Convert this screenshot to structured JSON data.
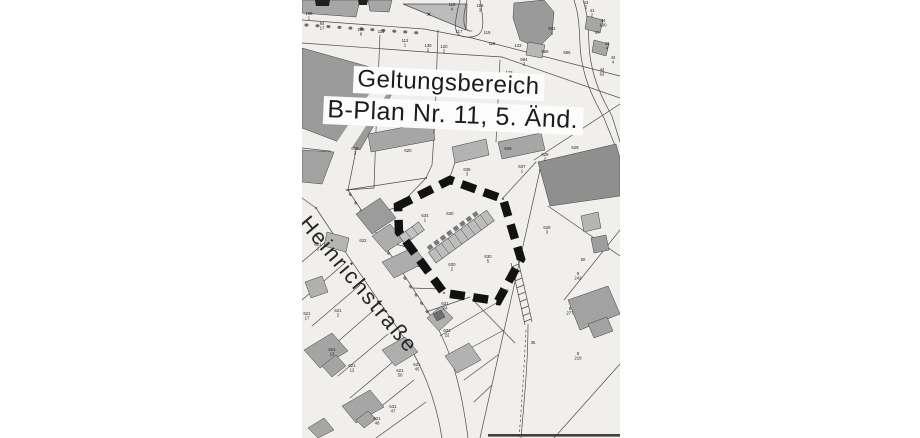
{
  "map": {
    "title_line1": "Geltungsbereich",
    "title_line2": "B-Plan Nr. 11, 5. Änd.",
    "street_name": "Heinrichstraße",
    "colors": {
      "paper": "#f1efec",
      "ink": "#4c4c4c",
      "building": "#a6a6a6",
      "boundary": "#121212",
      "label_ink": "#1f1f1f",
      "label_patch": "#fcfcfc",
      "title_ink": "#1c1c1c"
    },
    "parcel_labels": [
      {
        "x": 7,
        "y": 16,
        "t": "105/1"
      },
      {
        "x": 20,
        "y": 26,
        "t": "84/17"
      },
      {
        "x": 59,
        "y": 32,
        "t": "108/6"
      },
      {
        "x": 79,
        "y": 33,
        "t": "111"
      },
      {
        "x": 103,
        "y": 43,
        "t": "112/1"
      },
      {
        "x": 126,
        "y": 48,
        "t": "130/2"
      },
      {
        "x": 142,
        "y": 49,
        "t": "120/2"
      },
      {
        "x": 157,
        "y": 33,
        "t": "117"
      },
      {
        "x": 150,
        "y": 7,
        "t": "115/4"
      },
      {
        "x": 178,
        "y": 8,
        "t": "116/3"
      },
      {
        "x": 185,
        "y": 34,
        "t": "119"
      },
      {
        "x": 190,
        "y": 45,
        "t": "118"
      },
      {
        "x": 216,
        "y": 47,
        "t": "133"
      },
      {
        "x": 207,
        "y": 74,
        "t": "123"
      },
      {
        "x": 222,
        "y": 62,
        "t": "584/2"
      },
      {
        "x": 250,
        "y": 31,
        "t": "562/1"
      },
      {
        "x": 243,
        "y": 53,
        "t": "565"
      },
      {
        "x": 265,
        "y": 54,
        "t": "586"
      },
      {
        "x": 284,
        "y": 5,
        "t": "43/2"
      },
      {
        "x": 290,
        "y": 13,
        "t": "41/2"
      },
      {
        "x": 301,
        "y": 23,
        "t": "44/100"
      },
      {
        "x": 295,
        "y": 34,
        "t": "47"
      },
      {
        "x": 305,
        "y": 46,
        "t": "43/4"
      },
      {
        "x": 311,
        "y": 60,
        "t": "42/4"
      },
      {
        "x": 300,
        "y": 72,
        "t": "44/93"
      },
      {
        "x": 53,
        "y": 151,
        "t": "619/2"
      },
      {
        "x": 106,
        "y": 152,
        "t": "620"
      },
      {
        "x": 206,
        "y": 150,
        "t": "629"
      },
      {
        "x": 273,
        "y": 149,
        "t": "629"
      },
      {
        "x": 243,
        "y": 157,
        "t": "628/2"
      },
      {
        "x": 245,
        "y": 230,
        "t": "628/3"
      },
      {
        "x": 165,
        "y": 172,
        "t": "636/3"
      },
      {
        "x": 220,
        "y": 169,
        "t": "637/1"
      },
      {
        "x": 123,
        "y": 218,
        "t": "634/1"
      },
      {
        "x": 148,
        "y": 215,
        "t": "630"
      },
      {
        "x": 186,
        "y": 259,
        "t": "630/5"
      },
      {
        "x": 150,
        "y": 267,
        "t": "630/2"
      },
      {
        "x": 203,
        "y": 293,
        "t": "630/1"
      },
      {
        "x": 61,
        "y": 242,
        "t": "622"
      },
      {
        "x": 16,
        "y": 247,
        "t": "621/1"
      },
      {
        "x": 30,
        "y": 352,
        "t": "621/13"
      },
      {
        "x": 50,
        "y": 368,
        "t": "621/12"
      },
      {
        "x": 98,
        "y": 373,
        "t": "621/50"
      },
      {
        "x": 115,
        "y": 367,
        "t": "621/45"
      },
      {
        "x": 91,
        "y": 409,
        "t": "631/47"
      },
      {
        "x": 75,
        "y": 421,
        "t": "621/48"
      },
      {
        "x": 36,
        "y": 313,
        "t": "621/2"
      },
      {
        "x": 5,
        "y": 316,
        "t": "621/17"
      },
      {
        "x": 143,
        "y": 306,
        "t": "631/24"
      },
      {
        "x": 145,
        "y": 333,
        "t": "631/22"
      },
      {
        "x": 276,
        "y": 276,
        "t": "8/242"
      },
      {
        "x": 268,
        "y": 311,
        "t": "8/277"
      },
      {
        "x": 276,
        "y": 356,
        "t": "8/219"
      },
      {
        "x": 281,
        "y": 261,
        "t": "50"
      },
      {
        "x": 231,
        "y": 344,
        "t": "36"
      },
      {
        "x": 127,
        "y": 17,
        "t": "×",
        "s": 8
      }
    ]
  }
}
